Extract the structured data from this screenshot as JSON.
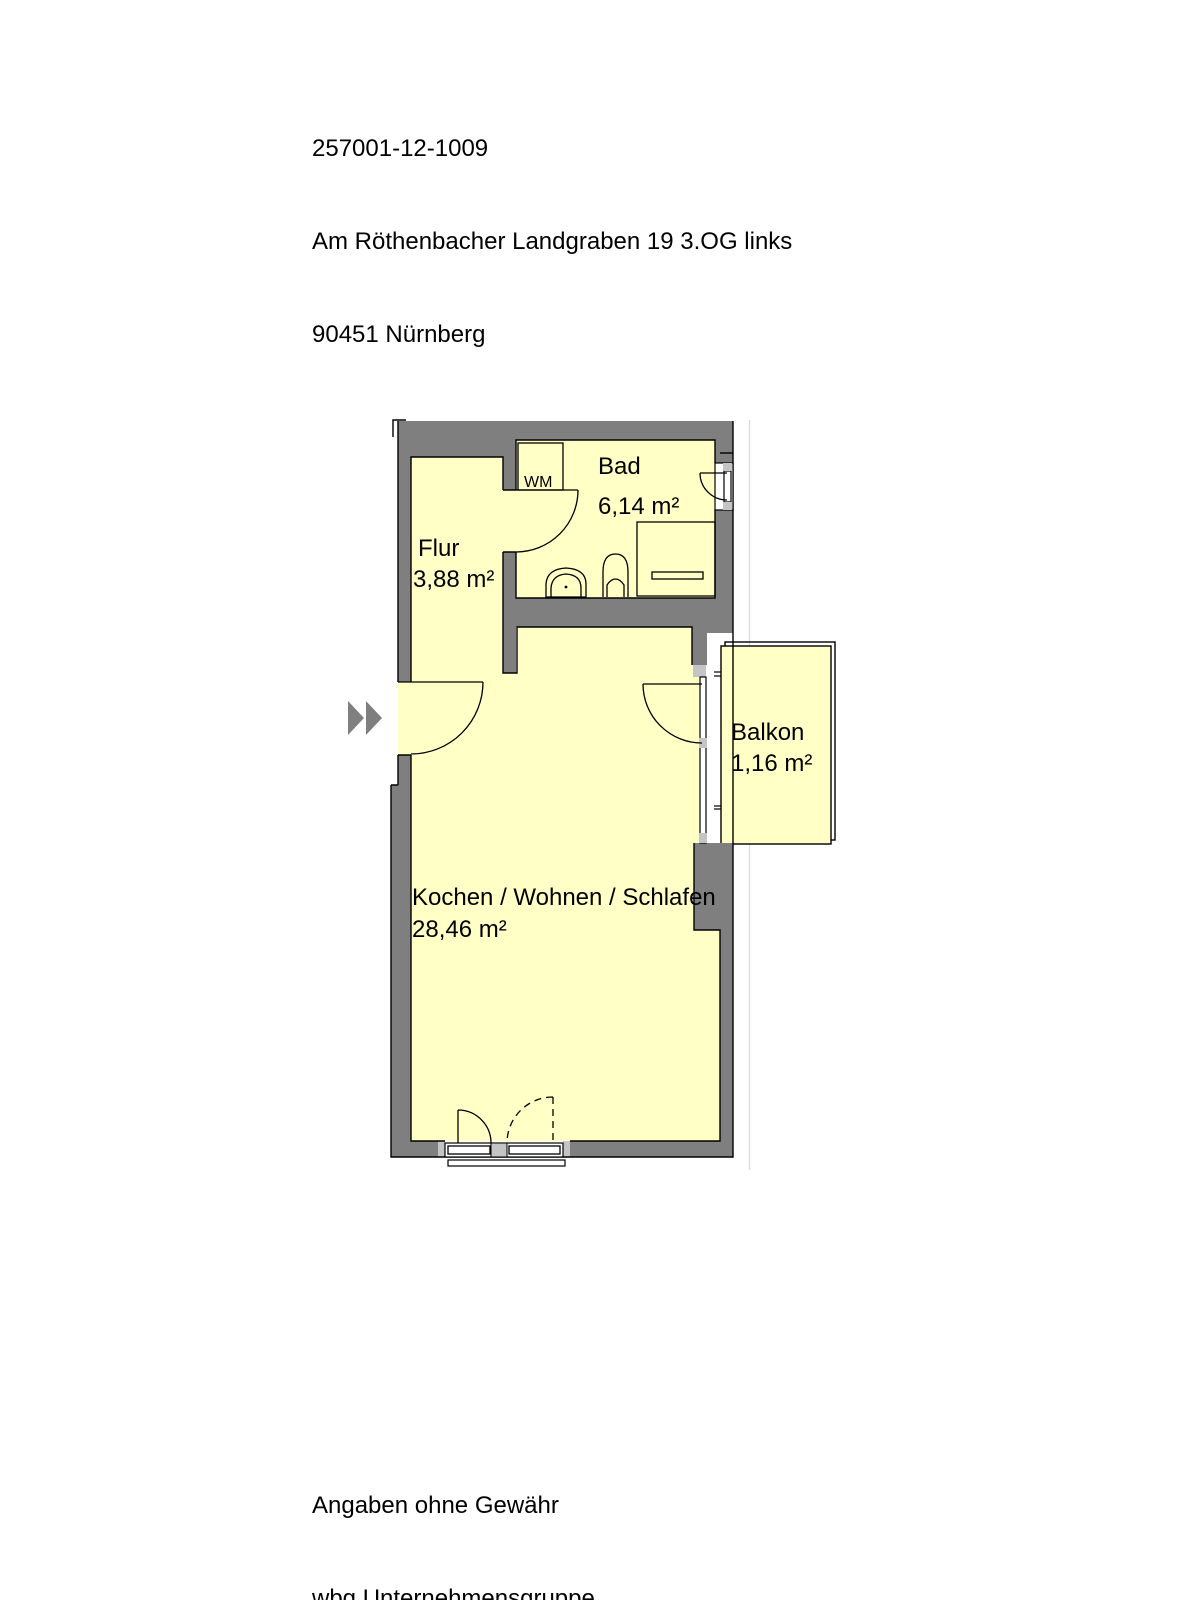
{
  "header": {
    "line1": "257001-12-1009",
    "line2": "Am Röthenbacher Landgraben 19 3.OG links",
    "line3": "90451 Nürnberg"
  },
  "floor_plan": {
    "rooms": [
      {
        "name": "Flur",
        "area": "3,88 m²"
      },
      {
        "name": "Bad",
        "area": "6,14 m²"
      },
      {
        "name": "Balkon",
        "area": "1,16 m²"
      },
      {
        "name": "Kochen / Wohnen / Schlafen",
        "area": "28,46 m²"
      }
    ],
    "labels": {
      "washing_machine": "WM"
    },
    "colors": {
      "wall": "#7F7F7F",
      "room_fill": "#FFFFC6",
      "frame_light": "#C4C4C4",
      "outline": "#000000"
    }
  },
  "footer": {
    "line1": "Angaben ohne Gewähr",
    "line2": "wbg Unternehmensgruppe"
  }
}
